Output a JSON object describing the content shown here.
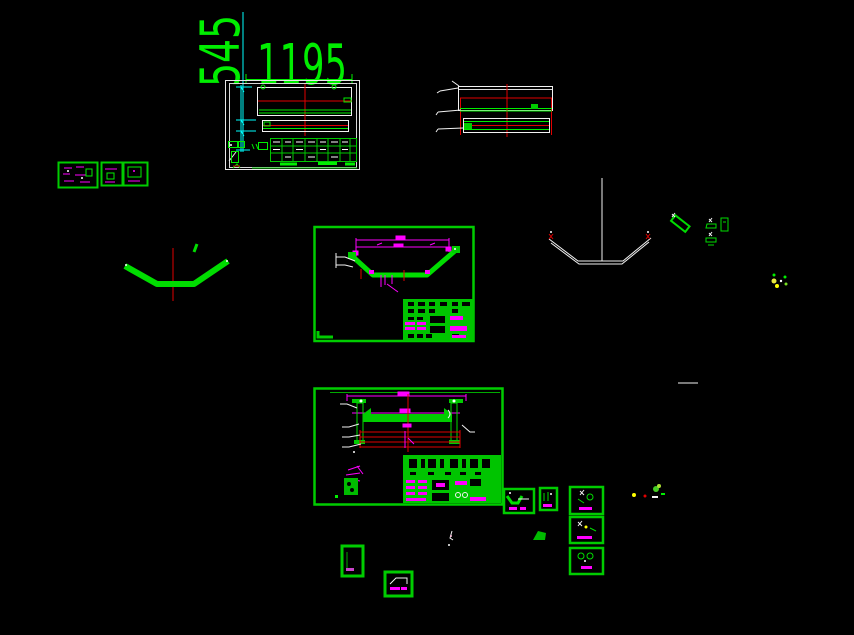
{
  "canvas": {
    "background": "#000000",
    "width": 854,
    "height": 635,
    "description_colors": {
      "line_green": "#00ee00",
      "solid_green_fill": "#00cc00",
      "dimension_magenta": "#ff00ff",
      "centerline_red": "#e00000",
      "outline_white": "#f2f2f2",
      "dimension_cyan": "#00ffff",
      "accent_yellow": "#ffff00"
    }
  },
  "dimension_labels": {
    "vertical": "545",
    "horizontal": "1195"
  }
}
